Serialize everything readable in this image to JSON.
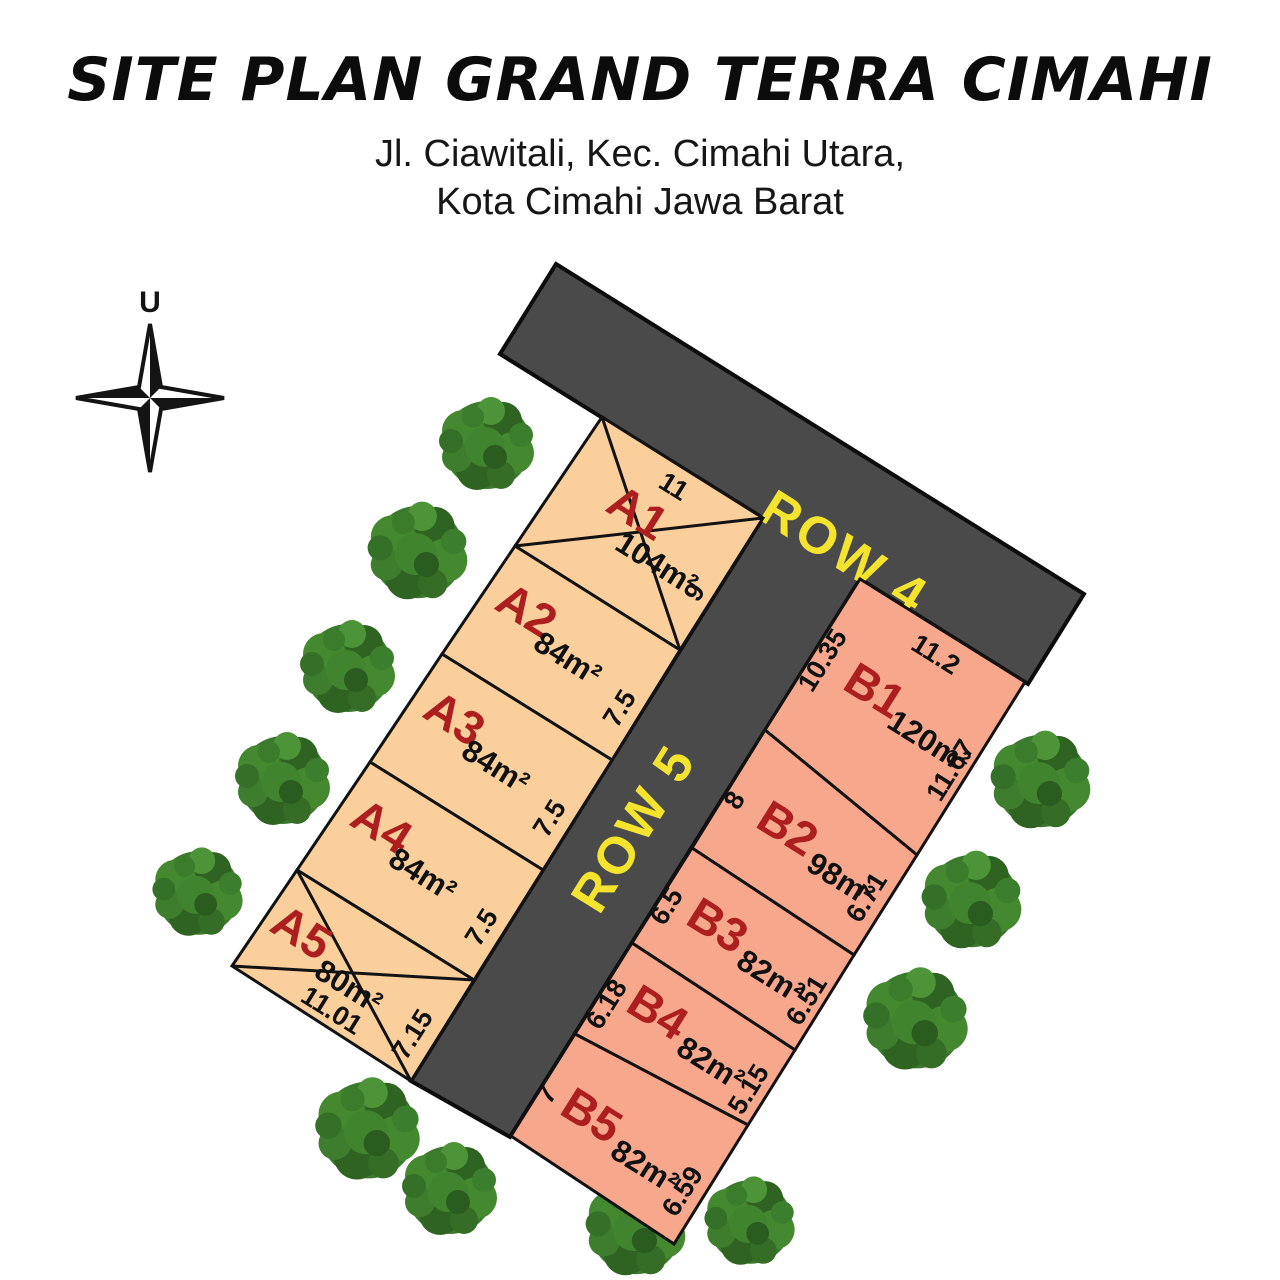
{
  "title": "SITE PLAN GRAND TERRA CIMAHI",
  "address": {
    "line1": "Jl. Ciawitali, Kec. Cimahi Utara,",
    "line2": "Kota Cimahi Jawa Barat"
  },
  "compass": {
    "north_label": "U"
  },
  "roads": [
    {
      "name": "ROW 4"
    },
    {
      "name": "ROW 5"
    }
  ],
  "colors": {
    "lot_a_fill": "#FBCF9C",
    "lot_b_fill": "#F7A78C",
    "road_fill": "#4A4A4A",
    "road_label_yellow": "#F4E42E",
    "lot_id_red": "#AD1F1F",
    "tree_green": "#3A7A2C"
  },
  "lots": [
    {
      "id": "A1",
      "area": "104m²",
      "crossed": true,
      "dims": {
        "top": "11",
        "right": "9"
      }
    },
    {
      "id": "A2",
      "area": "84m²",
      "crossed": false,
      "dims": {
        "right": "7.5"
      }
    },
    {
      "id": "A3",
      "area": "84m²",
      "crossed": false,
      "dims": {
        "right": "7.5"
      }
    },
    {
      "id": "A4",
      "area": "84m²",
      "crossed": false,
      "dims": {
        "right": "7.5"
      }
    },
    {
      "id": "A5",
      "area": "80m²",
      "crossed": true,
      "dims": {
        "right": "7.15",
        "bottom": "11.01"
      }
    },
    {
      "id": "B1",
      "area": "120m²",
      "crossed": false,
      "dims": {
        "left": "10.35",
        "top": "11.2",
        "right": "11.67"
      }
    },
    {
      "id": "B2",
      "area": "98m²",
      "crossed": false,
      "dims": {
        "left": "8",
        "right": "6.71"
      }
    },
    {
      "id": "B3",
      "area": "82m²",
      "crossed": false,
      "dims": {
        "left": "6.5",
        "right": "6.51"
      }
    },
    {
      "id": "B4",
      "area": "82m²",
      "crossed": false,
      "dims": {
        "left": "6.18",
        "right": "5.15"
      }
    },
    {
      "id": "B5",
      "area": "82m²",
      "crossed": false,
      "dims": {
        "left": "7",
        "right": "6.59"
      }
    }
  ]
}
